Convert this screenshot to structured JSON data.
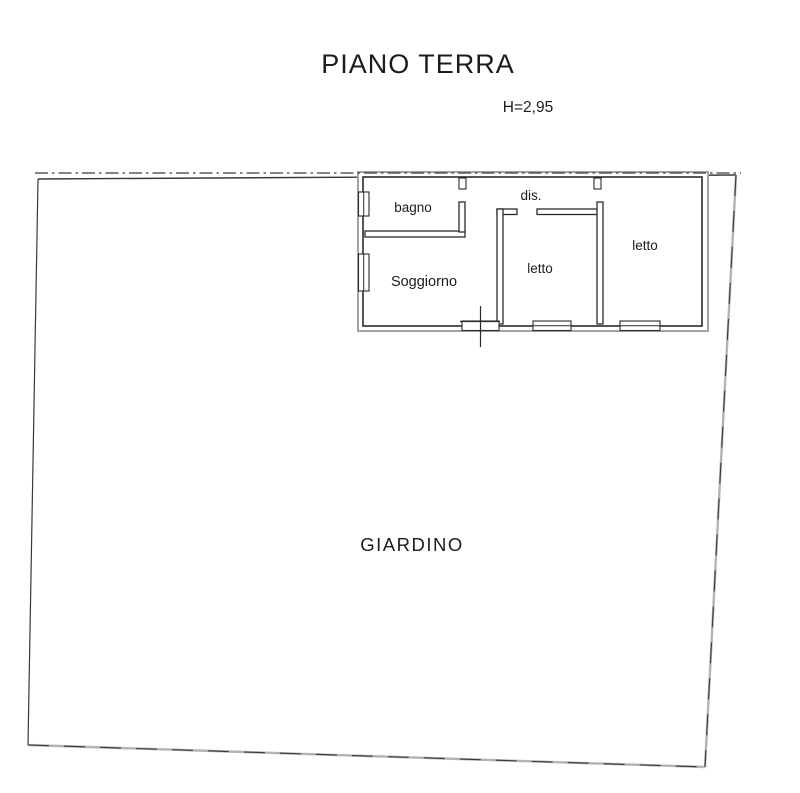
{
  "title": "PIANO TERRA",
  "ceiling_height": "H=2,95",
  "rooms": {
    "bagno": {
      "label": "bagno"
    },
    "dis": {
      "label": "dis."
    },
    "soggiorno": {
      "label": "Soggiorno"
    },
    "letto_center": {
      "label": "letto"
    },
    "letto_right": {
      "label": "letto"
    },
    "giardino": {
      "label": "GIARDINO"
    }
  },
  "colors": {
    "ink": "#1c1c1c",
    "wall": "#2b2b2b",
    "outer-wall": "#a3a3a3",
    "boundary-gray": "#b4b4b4",
    "boundary-dark": "#3a3a3a"
  }
}
